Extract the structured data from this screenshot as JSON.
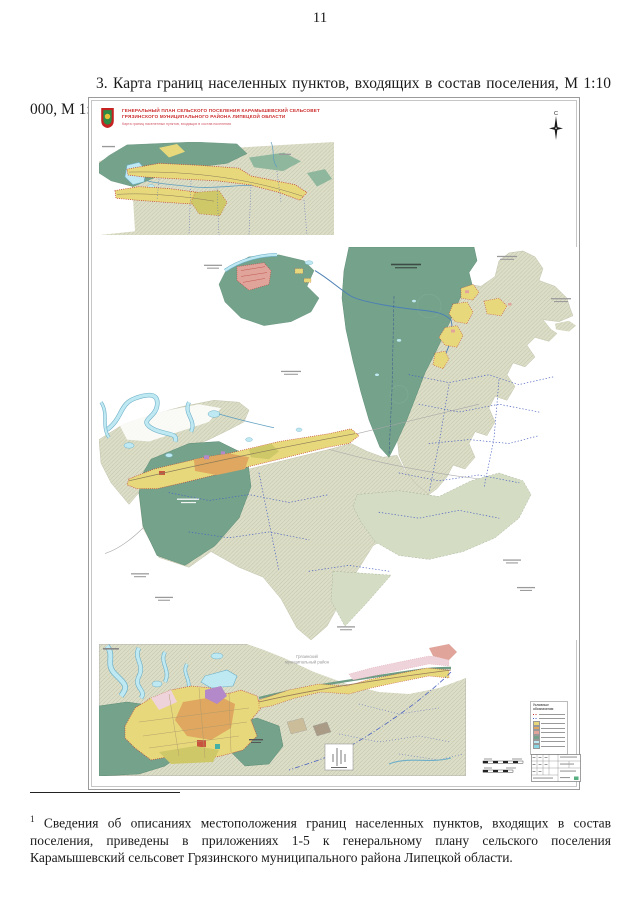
{
  "page": {
    "number": "11"
  },
  "heading": {
    "text": "3. Карта границ населенных пунктов, входящих в состав поселения, М 1:10 000, М 1:5000",
    "footnote_ref": "1"
  },
  "map": {
    "title_block": {
      "line1": "ГЕНЕРАЛЬНЫЙ ПЛАН СЕЛЬСКОГО ПОСЕЛЕНИЯ КАРАМЫШЕВСКИЙ СЕЛЬСОВЕТ",
      "line2": "ГРЯЗИНСКОГО МУНИЦИПАЛЬНОГО РАЙОНА ЛИПЕЦКОЙ ОБЛАСТИ",
      "subtitle": "Карта границ населенных пунктов, входящих в состав поселения"
    },
    "compass_north": "С",
    "labels": {
      "district_line1": "Грязинский",
      "district_line2": "муниципальный район"
    },
    "legend": {
      "title": "Условные обозначения"
    },
    "colors": {
      "forest": "#74a28b",
      "farmland_hatch": "#dcdec8",
      "farmland_light": "#d4dcc4",
      "residential": "#e7d97b",
      "residential_core": "#dfa75f",
      "settlement_pink": "#e0a49b",
      "pale_pink": "#efd3da",
      "purple_zone": "#b389c9",
      "water": "#bfe9f2",
      "water_edge": "#6fb0c8",
      "boundary_red": "#c03030",
      "boundary_blue": "#4a62c0",
      "title_red": "#cc2a2a"
    }
  },
  "footnote": {
    "marker": "1",
    "text": "Сведения об описаниях местоположения границ населенных пунктов, входящих в состав поселения, приведены в приложениях 1-5 к генеральному плану сельского поселения Карамышевский сельсовет Грязинского муниципального района Липецкой области."
  }
}
